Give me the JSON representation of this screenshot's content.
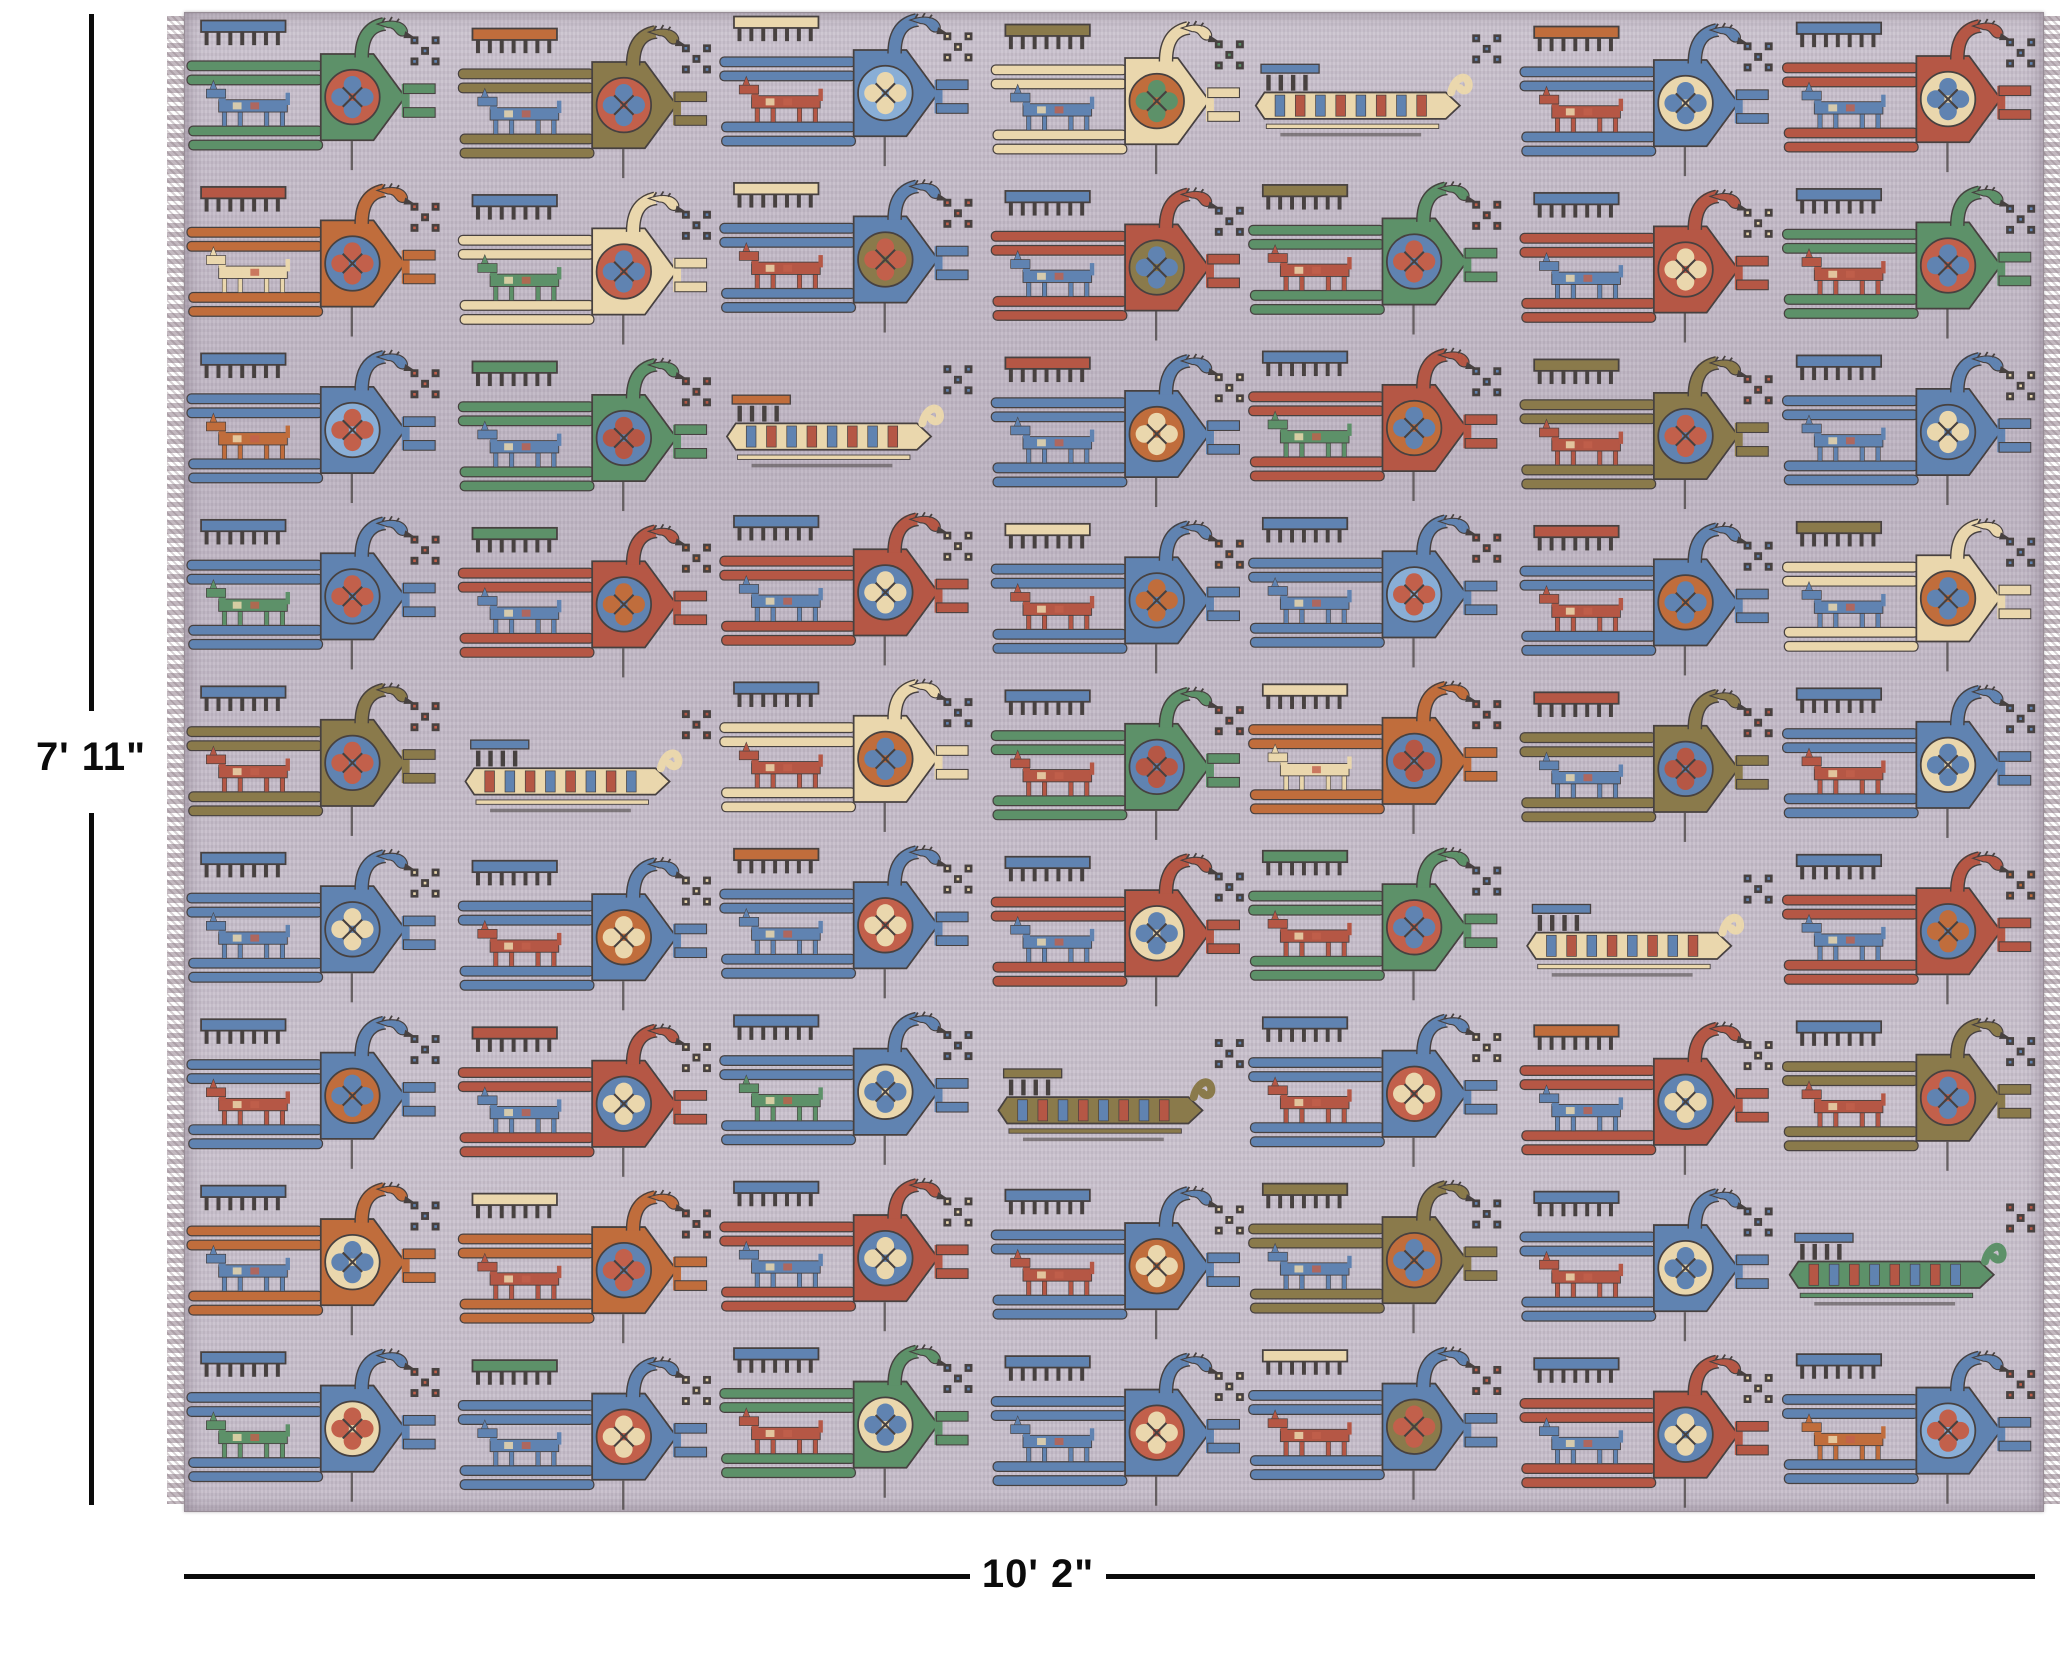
{
  "annotations": {
    "height_label": "7' 11\"",
    "width_label": "10' 2\""
  },
  "rug": {
    "background": "#c6bdca",
    "fringe_color": "#c3b9c0",
    "palette": {
      "outline": "#474140",
      "green": "#5d9169",
      "blue": "#6083b1",
      "lightblue": "#89aed6",
      "red": "#b55745",
      "salmon": "#c2604b",
      "orange": "#c06d3c",
      "olive": "#8a7a4b",
      "cream": "#ead7ad",
      "background": "#c6bdca"
    },
    "grid": {
      "columns": 7,
      "rows": 9,
      "col_x_offsets": [
        2,
        8,
        4,
        10,
        2,
        8,
        5
      ],
      "col_y_offsets": [
        4,
        12,
        0,
        8,
        2,
        10,
        6
      ],
      "cell_format": [
        "type",
        "body",
        "shield",
        "medallion",
        "horse",
        "comb"
      ],
      "cells": [
        [
          [
            "bird",
            "green",
            "salmon",
            "blue",
            "blue",
            "blue"
          ],
          [
            "bird",
            "olive",
            "salmon",
            "blue",
            "blue",
            "orange"
          ],
          [
            "bird",
            "blue",
            "lightblue",
            "cream",
            "red",
            "cream"
          ],
          [
            "bird",
            "cream",
            "orange",
            "green",
            "blue",
            "olive"
          ],
          [
            "sleigh",
            "cream",
            "red",
            "blue",
            "",
            "blue"
          ],
          [
            "bird",
            "blue",
            "cream",
            "blue",
            "red",
            "orange"
          ],
          [
            "bird",
            "red",
            "cream",
            "blue",
            "blue",
            "blue"
          ]
        ],
        [
          [
            "bird",
            "orange",
            "blue",
            "salmon",
            "cream",
            "red"
          ],
          [
            "bird",
            "cream",
            "salmon",
            "blue",
            "green",
            "blue"
          ],
          [
            "bird",
            "blue",
            "olive",
            "salmon",
            "red",
            "cream"
          ],
          [
            "bird",
            "red",
            "olive",
            "blue",
            "blue",
            "blue"
          ],
          [
            "bird",
            "green",
            "blue",
            "salmon",
            "red",
            "olive"
          ],
          [
            "bird",
            "red",
            "salmon",
            "cream",
            "blue",
            "blue"
          ],
          [
            "bird",
            "green",
            "salmon",
            "blue",
            "red",
            "blue"
          ]
        ],
        [
          [
            "bird",
            "blue",
            "lightblue",
            "salmon",
            "orange",
            "blue"
          ],
          [
            "bird",
            "green",
            "blue",
            "red",
            "blue",
            "green"
          ],
          [
            "sleigh",
            "cream",
            "red",
            "blue",
            "",
            "orange"
          ],
          [
            "bird",
            "blue",
            "orange",
            "cream",
            "blue",
            "red"
          ],
          [
            "bird",
            "red",
            "orange",
            "blue",
            "green",
            "blue"
          ],
          [
            "bird",
            "olive",
            "blue",
            "salmon",
            "red",
            "olive"
          ],
          [
            "bird",
            "blue",
            "blue",
            "cream",
            "blue",
            "blue"
          ]
        ],
        [
          [
            "bird",
            "blue",
            "blue",
            "salmon",
            "green",
            "blue"
          ],
          [
            "bird",
            "red",
            "blue",
            "orange",
            "blue",
            "green"
          ],
          [
            "bird",
            "red",
            "blue",
            "cream",
            "blue",
            "blue"
          ],
          [
            "bird",
            "blue",
            "blue",
            "orange",
            "red",
            "cream"
          ],
          [
            "bird",
            "blue",
            "lightblue",
            "salmon",
            "blue",
            "blue"
          ],
          [
            "bird",
            "blue",
            "orange",
            "blue",
            "red",
            "red"
          ],
          [
            "bird",
            "cream",
            "orange",
            "blue",
            "blue",
            "olive"
          ]
        ],
        [
          [
            "bird",
            "olive",
            "blue",
            "salmon",
            "red",
            "blue"
          ],
          [
            "sleigh",
            "cream",
            "blue",
            "red",
            "",
            "blue"
          ],
          [
            "bird",
            "cream",
            "orange",
            "blue",
            "red",
            "blue"
          ],
          [
            "bird",
            "green",
            "blue",
            "red",
            "red",
            "blue"
          ],
          [
            "bird",
            "orange",
            "blue",
            "red",
            "cream",
            "cream"
          ],
          [
            "bird",
            "olive",
            "blue",
            "red",
            "blue",
            "red"
          ],
          [
            "bird",
            "blue",
            "cream",
            "blue",
            "red",
            "blue"
          ]
        ],
        [
          [
            "bird",
            "blue",
            "blue",
            "cream",
            "blue",
            "blue"
          ],
          [
            "bird",
            "blue",
            "orange",
            "cream",
            "red",
            "blue"
          ],
          [
            "bird",
            "blue",
            "salmon",
            "cream",
            "blue",
            "orange"
          ],
          [
            "bird",
            "red",
            "cream",
            "blue",
            "blue",
            "blue"
          ],
          [
            "bird",
            "green",
            "salmon",
            "blue",
            "red",
            "green"
          ],
          [
            "sleigh",
            "cream",
            "red",
            "blue",
            "",
            "blue"
          ],
          [
            "bird",
            "red",
            "blue",
            "orange",
            "blue",
            "blue"
          ]
        ],
        [
          [
            "bird",
            "blue",
            "orange",
            "blue",
            "red",
            "blue"
          ],
          [
            "bird",
            "red",
            "blue",
            "cream",
            "blue",
            "red"
          ],
          [
            "bird",
            "blue",
            "cream",
            "blue",
            "green",
            "blue"
          ],
          [
            "sleigh",
            "olive",
            "red",
            "blue",
            "",
            "olive"
          ],
          [
            "bird",
            "blue",
            "salmon",
            "cream",
            "red",
            "blue"
          ],
          [
            "bird",
            "red",
            "blue",
            "cream",
            "blue",
            "orange"
          ],
          [
            "bird",
            "olive",
            "salmon",
            "blue",
            "red",
            "blue"
          ]
        ],
        [
          [
            "bird",
            "orange",
            "cream",
            "blue",
            "blue",
            "blue"
          ],
          [
            "bird",
            "orange",
            "blue",
            "salmon",
            "red",
            "cream"
          ],
          [
            "bird",
            "red",
            "blue",
            "cream",
            "blue",
            "blue"
          ],
          [
            "bird",
            "blue",
            "orange",
            "cream",
            "red",
            "blue"
          ],
          [
            "bird",
            "olive",
            "orange",
            "blue",
            "blue",
            "olive"
          ],
          [
            "bird",
            "blue",
            "cream",
            "blue",
            "red",
            "blue"
          ],
          [
            "sleigh",
            "green",
            "blue",
            "red",
            "",
            "blue"
          ]
        ],
        [
          [
            "bird",
            "blue",
            "cream",
            "salmon",
            "green",
            "blue"
          ],
          [
            "bird",
            "blue",
            "salmon",
            "cream",
            "blue",
            "green"
          ],
          [
            "bird",
            "green",
            "cream",
            "blue",
            "red",
            "blue"
          ],
          [
            "bird",
            "blue",
            "salmon",
            "cream",
            "blue",
            "blue"
          ],
          [
            "bird",
            "blue",
            "olive",
            "salmon",
            "red",
            "cream"
          ],
          [
            "bird",
            "red",
            "blue",
            "cream",
            "blue",
            "blue"
          ],
          [
            "bird",
            "blue",
            "lightblue",
            "salmon",
            "orange",
            "blue"
          ]
        ]
      ]
    }
  }
}
